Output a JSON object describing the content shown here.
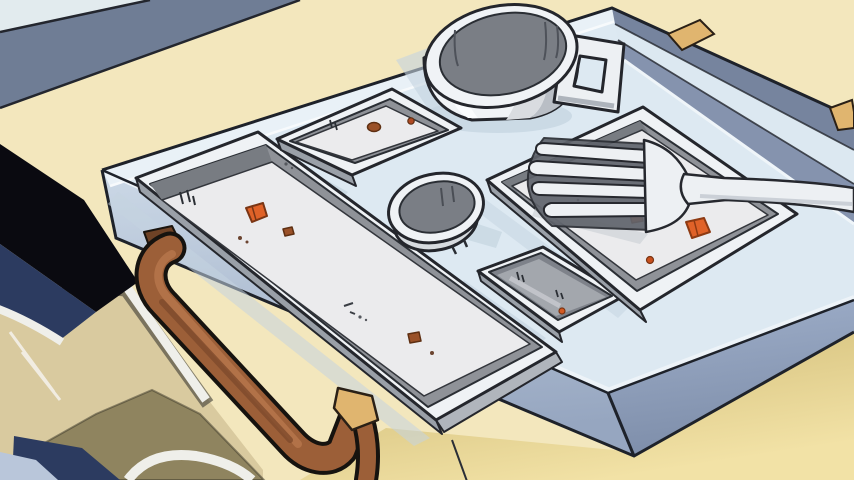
{
  "scene": {
    "description": "Anime-style still: an empty pale-blue lunch tray on a table, seen from a low diagonal angle. The tray holds an empty mug with a square handle, a long rectangular dish, a small square dish, a small round cup, a small rectangular dish, and a large square dish with a white fork resting in it. Leftover orange and brown food crumbs dot the dishes. A brown carry handle is mounted on the tray's near edge. A person's shoulder (dark hair, navy and tan clothing) occupies the bottom-left corner.",
    "objects": [
      "table",
      "background-wall-band",
      "lunch-tray",
      "tray-handle",
      "wooden-latch-pegs",
      "mug",
      "long-rect-dish",
      "small-square-dish",
      "round-cup",
      "small-rect-dish",
      "large-square-dish",
      "fork",
      "food-crumbs",
      "person-shoulder"
    ]
  },
  "palette": {
    "table_cream": "#F3E7BD",
    "wall_pale": "#E2EBEE",
    "wall_slate": "#6F7D95",
    "tray_floor": "#DDE9F2",
    "tray_rim_light": "#DCE8F1",
    "tray_inner_wall": "#8593AE",
    "tray_outer_wall": "#76849E",
    "dish_rim": "#EFF2F5",
    "dish_wall": "#8F9298",
    "dish_wall_dark": "#787C82",
    "dish_floor": "#EBEBED",
    "dish_floor_dark": "#A3A7AD",
    "mug_interior": "#7A7E85",
    "shadow_blue": "#C4D4E0",
    "handle_sienna": "#9C5F38",
    "handle_highlight": "#B5744A",
    "wood_tan": "#E0B56F",
    "food_orange": "#E06228",
    "food_brown": "#9A5128",
    "person_black": "#0A0A10",
    "person_navy": "#2C3B60",
    "person_tan": "#D9CA9F",
    "person_khaki": "#8F845F",
    "person_trim": "#EFEFEA",
    "person_pale_blue": "#B9C6DA",
    "outline": "#20242C"
  }
}
